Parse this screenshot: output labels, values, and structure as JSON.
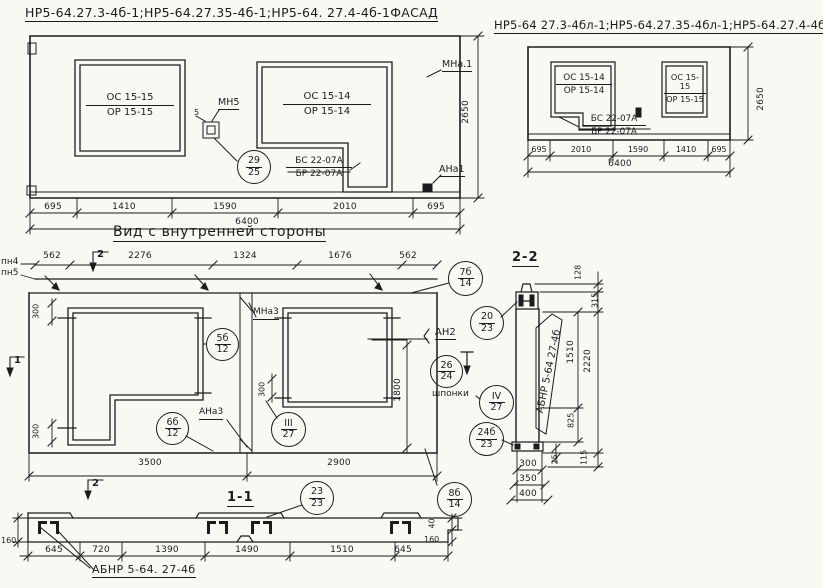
{
  "facade_left": {
    "title": "НР5-64.27.3-4б-1;НР5-64.27.35-4б-1;НР5-64. 27.4-4б-1ФАСАД",
    "window_left_label": {
      "top": "ОС 15-15",
      "bottom": "ОР 15-15"
    },
    "window_right_label": {
      "top": "ОС 15-14",
      "bottom": "ОР 15-14"
    },
    "block_label": {
      "top": "БС 22-07А",
      "bottom": "БР 22-07А"
    },
    "anchor_mn5": "МН5",
    "dim_5": "5",
    "bubble_29_25": {
      "top": "29",
      "bottom": "25"
    },
    "anchor_mna1": "МНа.1",
    "anchor_ana1": "АНа1",
    "dim_height": "2650",
    "dims_bottom": [
      "695",
      "1410",
      "1590",
      "2010",
      "695"
    ],
    "dim_total": "6400"
  },
  "facade_right": {
    "title": "НР5-64 27.3-4бл-1;НР5-64.27.35-4бл-1;НР5-64.27.4-4бл-1.ФАСАД",
    "window_left_label": {
      "top": "ОС 15-14",
      "bottom": "ОР 15-14"
    },
    "window_right_label": {
      "top": "ОС 15-15",
      "bottom": "ОР 15-15"
    },
    "block_label": {
      "top": "БС 22-07А",
      "bottom": "БР 22-07А"
    },
    "dim_height": "2650",
    "dims_bottom": [
      "695",
      "2010",
      "1590",
      "1410",
      "695"
    ],
    "dim_total": "6400"
  },
  "inner_view": {
    "title": "Вид с внутренней стороны",
    "dims_top": [
      "562",
      "2276",
      "1324",
      "1676",
      "562"
    ],
    "label_pn4": "пн4",
    "label_pn5": "пн5",
    "marker_1": "1",
    "marker_2": "2",
    "dim_300": "300",
    "dim_1800": "1800",
    "anchor_mna3": "МНа3",
    "anchor_ana3": "АНа3",
    "anchor_an2": "АН2",
    "label_shponki": "шпонки",
    "bubble_5b_12": {
      "top": "5б",
      "bottom": "12"
    },
    "bubble_6b_12": {
      "top": "6б",
      "bottom": "12"
    },
    "bubble_7b_14": {
      "top": "7б",
      "bottom": "14"
    },
    "bubble_8b_14": {
      "top": "8б",
      "bottom": "14"
    },
    "bubble_iii_27": {
      "top": "III",
      "bottom": "27"
    },
    "bubble_iv_27": {
      "top": "IV",
      "bottom": "27"
    },
    "bubble_20_23": {
      "top": "20",
      "bottom": "23"
    },
    "bubble_26_24": {
      "top": "26",
      "bottom": "24"
    },
    "bubble_24b_23": {
      "top": "24б",
      "bottom": "23"
    },
    "dims_bottom": [
      "3500",
      "2900"
    ]
  },
  "section_2_2": {
    "title": "2-2",
    "panel_mark": "АБНР 5-64 27-4б",
    "dim_128": "128",
    "dim_315": "315",
    "dim_1510": "1510",
    "dim_2220": "2220",
    "dim_825": "825",
    "dim_25": "25",
    "dim_115": "115",
    "dims_bottom": [
      "300",
      "350",
      "400"
    ]
  },
  "section_1_1": {
    "title": "1-1",
    "bubble_23_23": {
      "top": "23",
      "bottom": "23"
    },
    "panel_mark": "АБНР 5-64. 27-4б",
    "dims_bottom": [
      "645",
      "720",
      "1390",
      "1490",
      "1510",
      "645"
    ],
    "dim_160_left": "160",
    "dim_160_right": "160",
    "dim_40": "40"
  }
}
